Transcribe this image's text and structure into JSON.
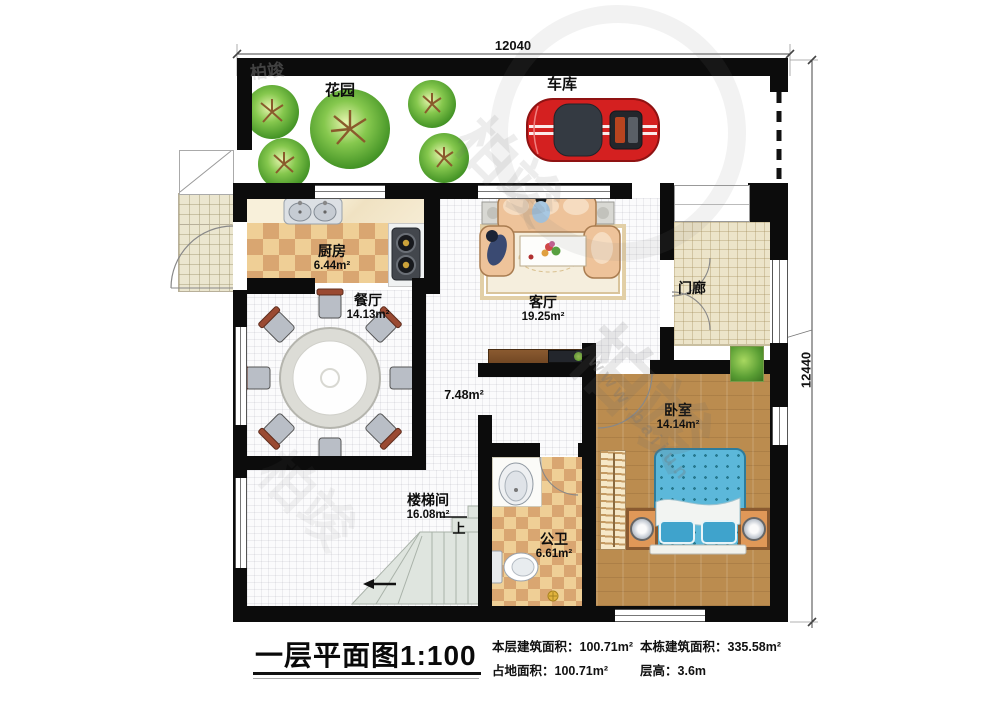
{
  "dimensions": {
    "width_mm": "12040",
    "height_mm": "12440"
  },
  "garden": {
    "label": "花园"
  },
  "garage": {
    "label": "车库"
  },
  "rooms": {
    "kitchen": {
      "name": "厨房",
      "area": "6.44m²"
    },
    "dining": {
      "name": "餐厅",
      "area": "14.13m²"
    },
    "living": {
      "name": "客厅",
      "area": "19.25m²"
    },
    "porch": {
      "name": "门廊"
    },
    "hallway": {
      "area": "7.48m²"
    },
    "bedroom": {
      "name": "卧室",
      "area": "14.14m²"
    },
    "stairwell": {
      "name": "楼梯间",
      "area": "16.08m²"
    },
    "bathroom": {
      "name": "公卫",
      "area": "6.61m²"
    }
  },
  "stairs": {
    "up_label": "上"
  },
  "title_block": {
    "title": "一层平面图",
    "scale": "1:100",
    "stats": [
      {
        "label": "本层建筑面积：",
        "value": "100.71m²"
      },
      {
        "label": "占地面积：",
        "value": "100.71m²"
      },
      {
        "label": "本栋建筑面积：",
        "value": "335.58m²"
      },
      {
        "label": "层高：",
        "value": "3.6m"
      }
    ]
  },
  "watermark": {
    "brand": "柏竣",
    "url": "www.baijun"
  },
  "colors": {
    "wall": "#0c0c0c",
    "wood_floor": "#bb8c4f",
    "bed_blue": "#5cb8da",
    "sofa_peach": "#eec39a",
    "car_red": "#d42020",
    "checker_dark": "#d9a671",
    "checker_light": "#efcf96"
  }
}
